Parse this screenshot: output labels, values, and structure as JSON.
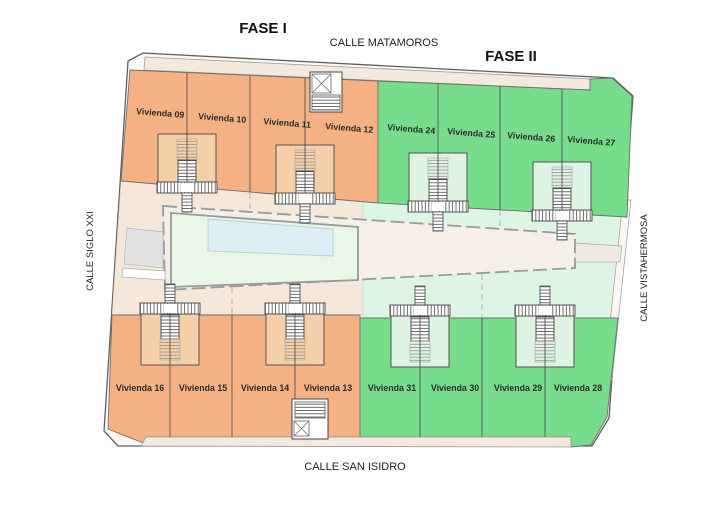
{
  "legend": {
    "fase1_label": "FASE I",
    "fase2_label": "FASE II"
  },
  "streets": {
    "top": "CALLE MATAMOROS",
    "bottom": "CALLE SAN ISIDRO",
    "left": "CALLE SIGLO XXI",
    "right": "CALLE VISTAHERMOSA"
  },
  "blocks": {
    "fase1_top": {
      "phase": "FASE I",
      "units": [
        "Vivienda 09",
        "Vivienda 10",
        "Vivienda 11",
        "Vivienda 12"
      ]
    },
    "fase2_top": {
      "phase": "FASE II",
      "units": [
        "Vivienda 24",
        "Vivienda 25",
        "Vivienda 26",
        "Vivienda 27"
      ]
    },
    "fase1_bottom": {
      "phase": "FASE I",
      "units": [
        "Vivienda 16",
        "Vivienda 15",
        "Vivienda 14",
        "Vivienda 13"
      ]
    },
    "fase2_bottom": {
      "phase": "FASE II",
      "units": [
        "Vivienda 31",
        "Vivienda 30",
        "Vivienda 29",
        "Vivienda 28"
      ]
    }
  },
  "colors": {
    "fase1": "#F5B183",
    "fase1_light": "#F4CFA9",
    "fase2": "#77DC8B",
    "fase2_light": "#DFF3E2",
    "pale_peach": "#F5E7DA",
    "pale_green": "#DFF5E4",
    "pool": "#DCEFF5",
    "courtyard": "#E9F7E6",
    "sidewalk": "#F4E9DE",
    "building": "#F5EFE8",
    "plan_fill": "#FCF9F5",
    "gray_zone": "#E2E2E2"
  }
}
